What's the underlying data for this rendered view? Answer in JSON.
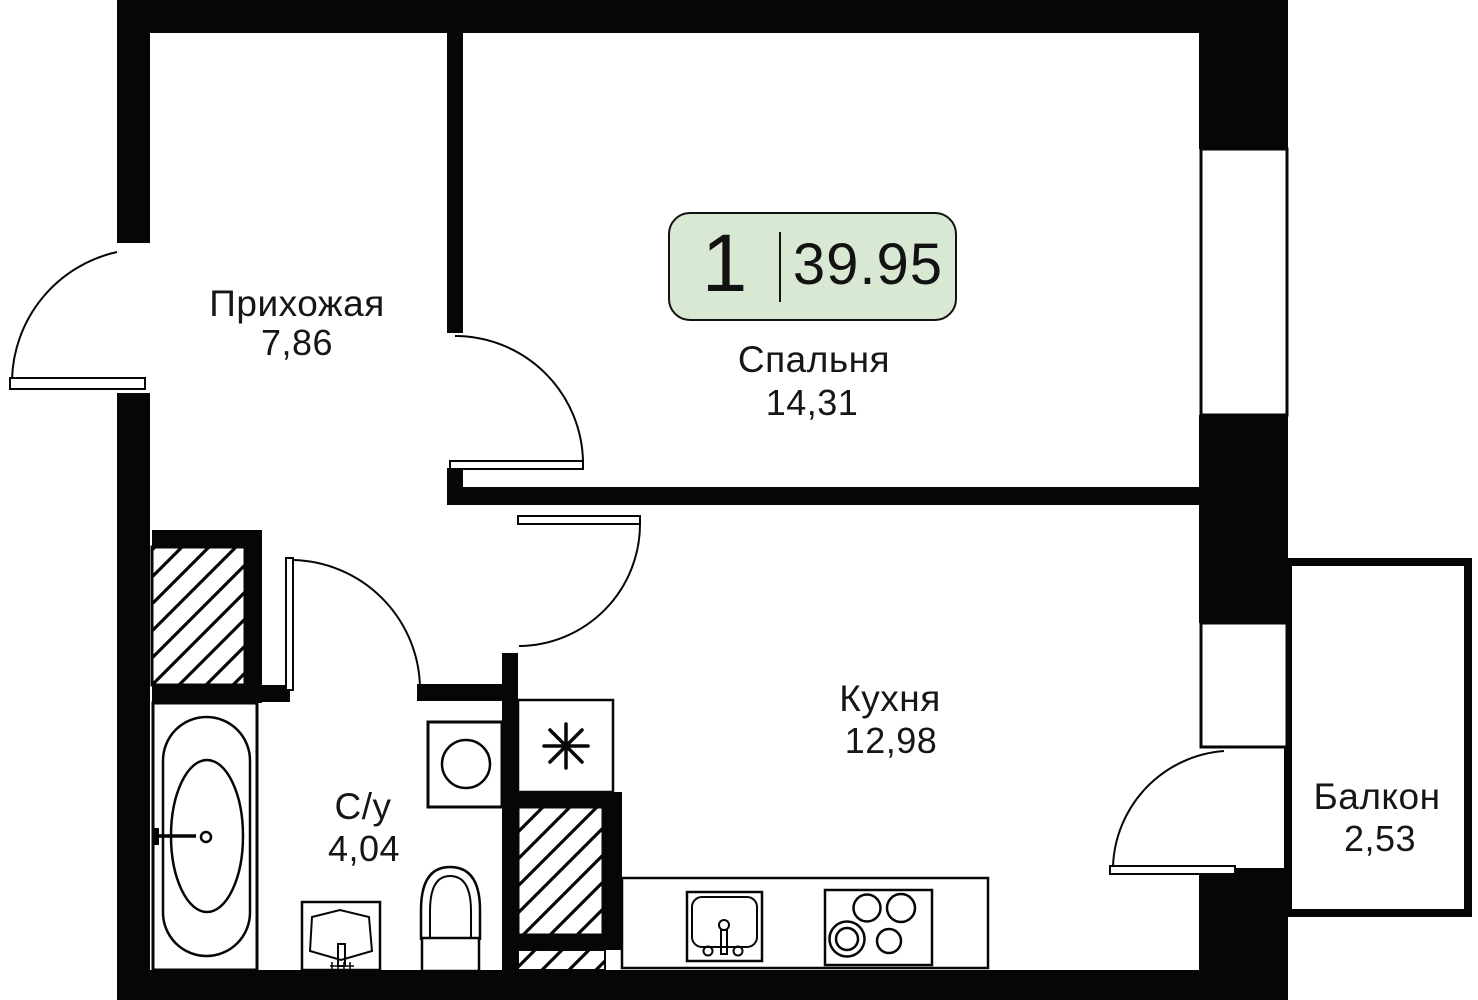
{
  "plan": {
    "type": "apartment-floor-plan",
    "badge": {
      "rooms_count": "1",
      "total_area": "39.95"
    },
    "rooms": {
      "hallway": {
        "name": "Прихожая",
        "area": "7,86"
      },
      "bedroom": {
        "name": "Спальня",
        "area": "14,31"
      },
      "kitchen": {
        "name": "Кухня",
        "area": "12,98"
      },
      "bathroom": {
        "name": "С/у",
        "area": "4,04"
      },
      "balcony": {
        "name": "Балкон",
        "area": "2,53"
      }
    },
    "icons": {
      "niche_symbol": "asterisk-star",
      "fixtures": [
        "bathtub",
        "washing-machine",
        "toilet",
        "wash-basin",
        "kitchen-sink",
        "stove-4-burners"
      ],
      "shafts": "diagonal-hatch"
    },
    "colors": {
      "walls": "#060606",
      "background": "#ffffff",
      "badge_fill": "#d8e8d2",
      "badge_border": "#111111",
      "text": "#161616"
    }
  }
}
